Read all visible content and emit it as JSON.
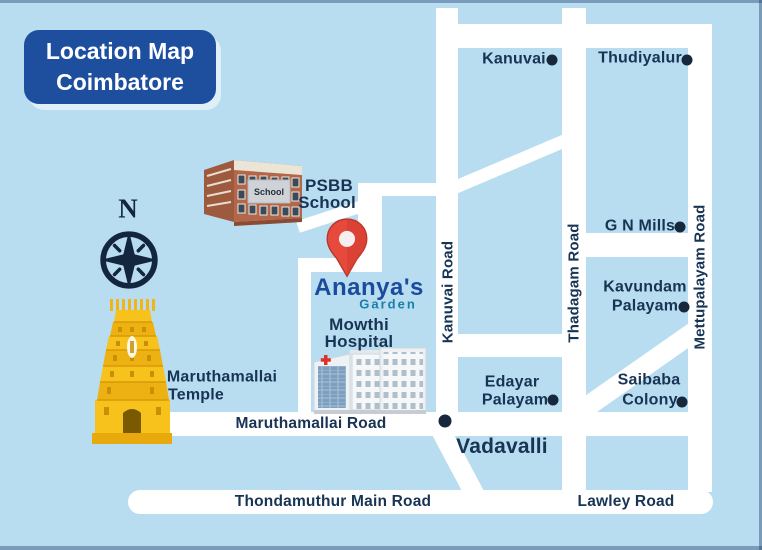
{
  "title": {
    "line1": "Location Map",
    "line2": "Coimbatore"
  },
  "compass": {
    "north_label": "N"
  },
  "logo": {
    "name": "Ananya's",
    "sub": "Garden"
  },
  "roads": {
    "kanuvai": "Kanuvai Road",
    "thadagam": "Thadagam Road",
    "mettupalayam": "Mettupalayam Road",
    "maruthamallai": "Maruthamallai Road",
    "thondamuthur": "Thondamuthur Main Road",
    "lawley": "Lawley Road"
  },
  "places": {
    "kanuvai": {
      "line1": "Kanuvai"
    },
    "thudiyalur": {
      "line1": "Thudiyalur"
    },
    "gnmills": {
      "line1": "G N Mills"
    },
    "kavundam": {
      "line1": "Kavundam",
      "line2": "Palayam"
    },
    "saibaba": {
      "line1": "Saibaba",
      "line2": "Colony"
    },
    "edayar": {
      "line1": "Edayar",
      "line2": "Palayam"
    },
    "vadavalli": {
      "line1": "Vadavalli"
    },
    "mowthi": {
      "line1": "Mowthi",
      "line2": "Hospital"
    },
    "psbb": {
      "line1": "PSBB",
      "line2": "School"
    },
    "temple": {
      "line1": "Maruthamallai",
      "line2": "Temple"
    }
  },
  "buildings": {
    "school_sign": "School"
  },
  "colors": {
    "background": "#b9ddf0",
    "road": "#ffffff",
    "title_bg": "#1e4f9f",
    "label_text": "#183454",
    "logo_primary": "#1b4c9c",
    "logo_accent": "#187fa9",
    "pin_red": "#e64a3d",
    "temple_yellow": "#f6c21b",
    "marker_dot": "#17283c"
  }
}
